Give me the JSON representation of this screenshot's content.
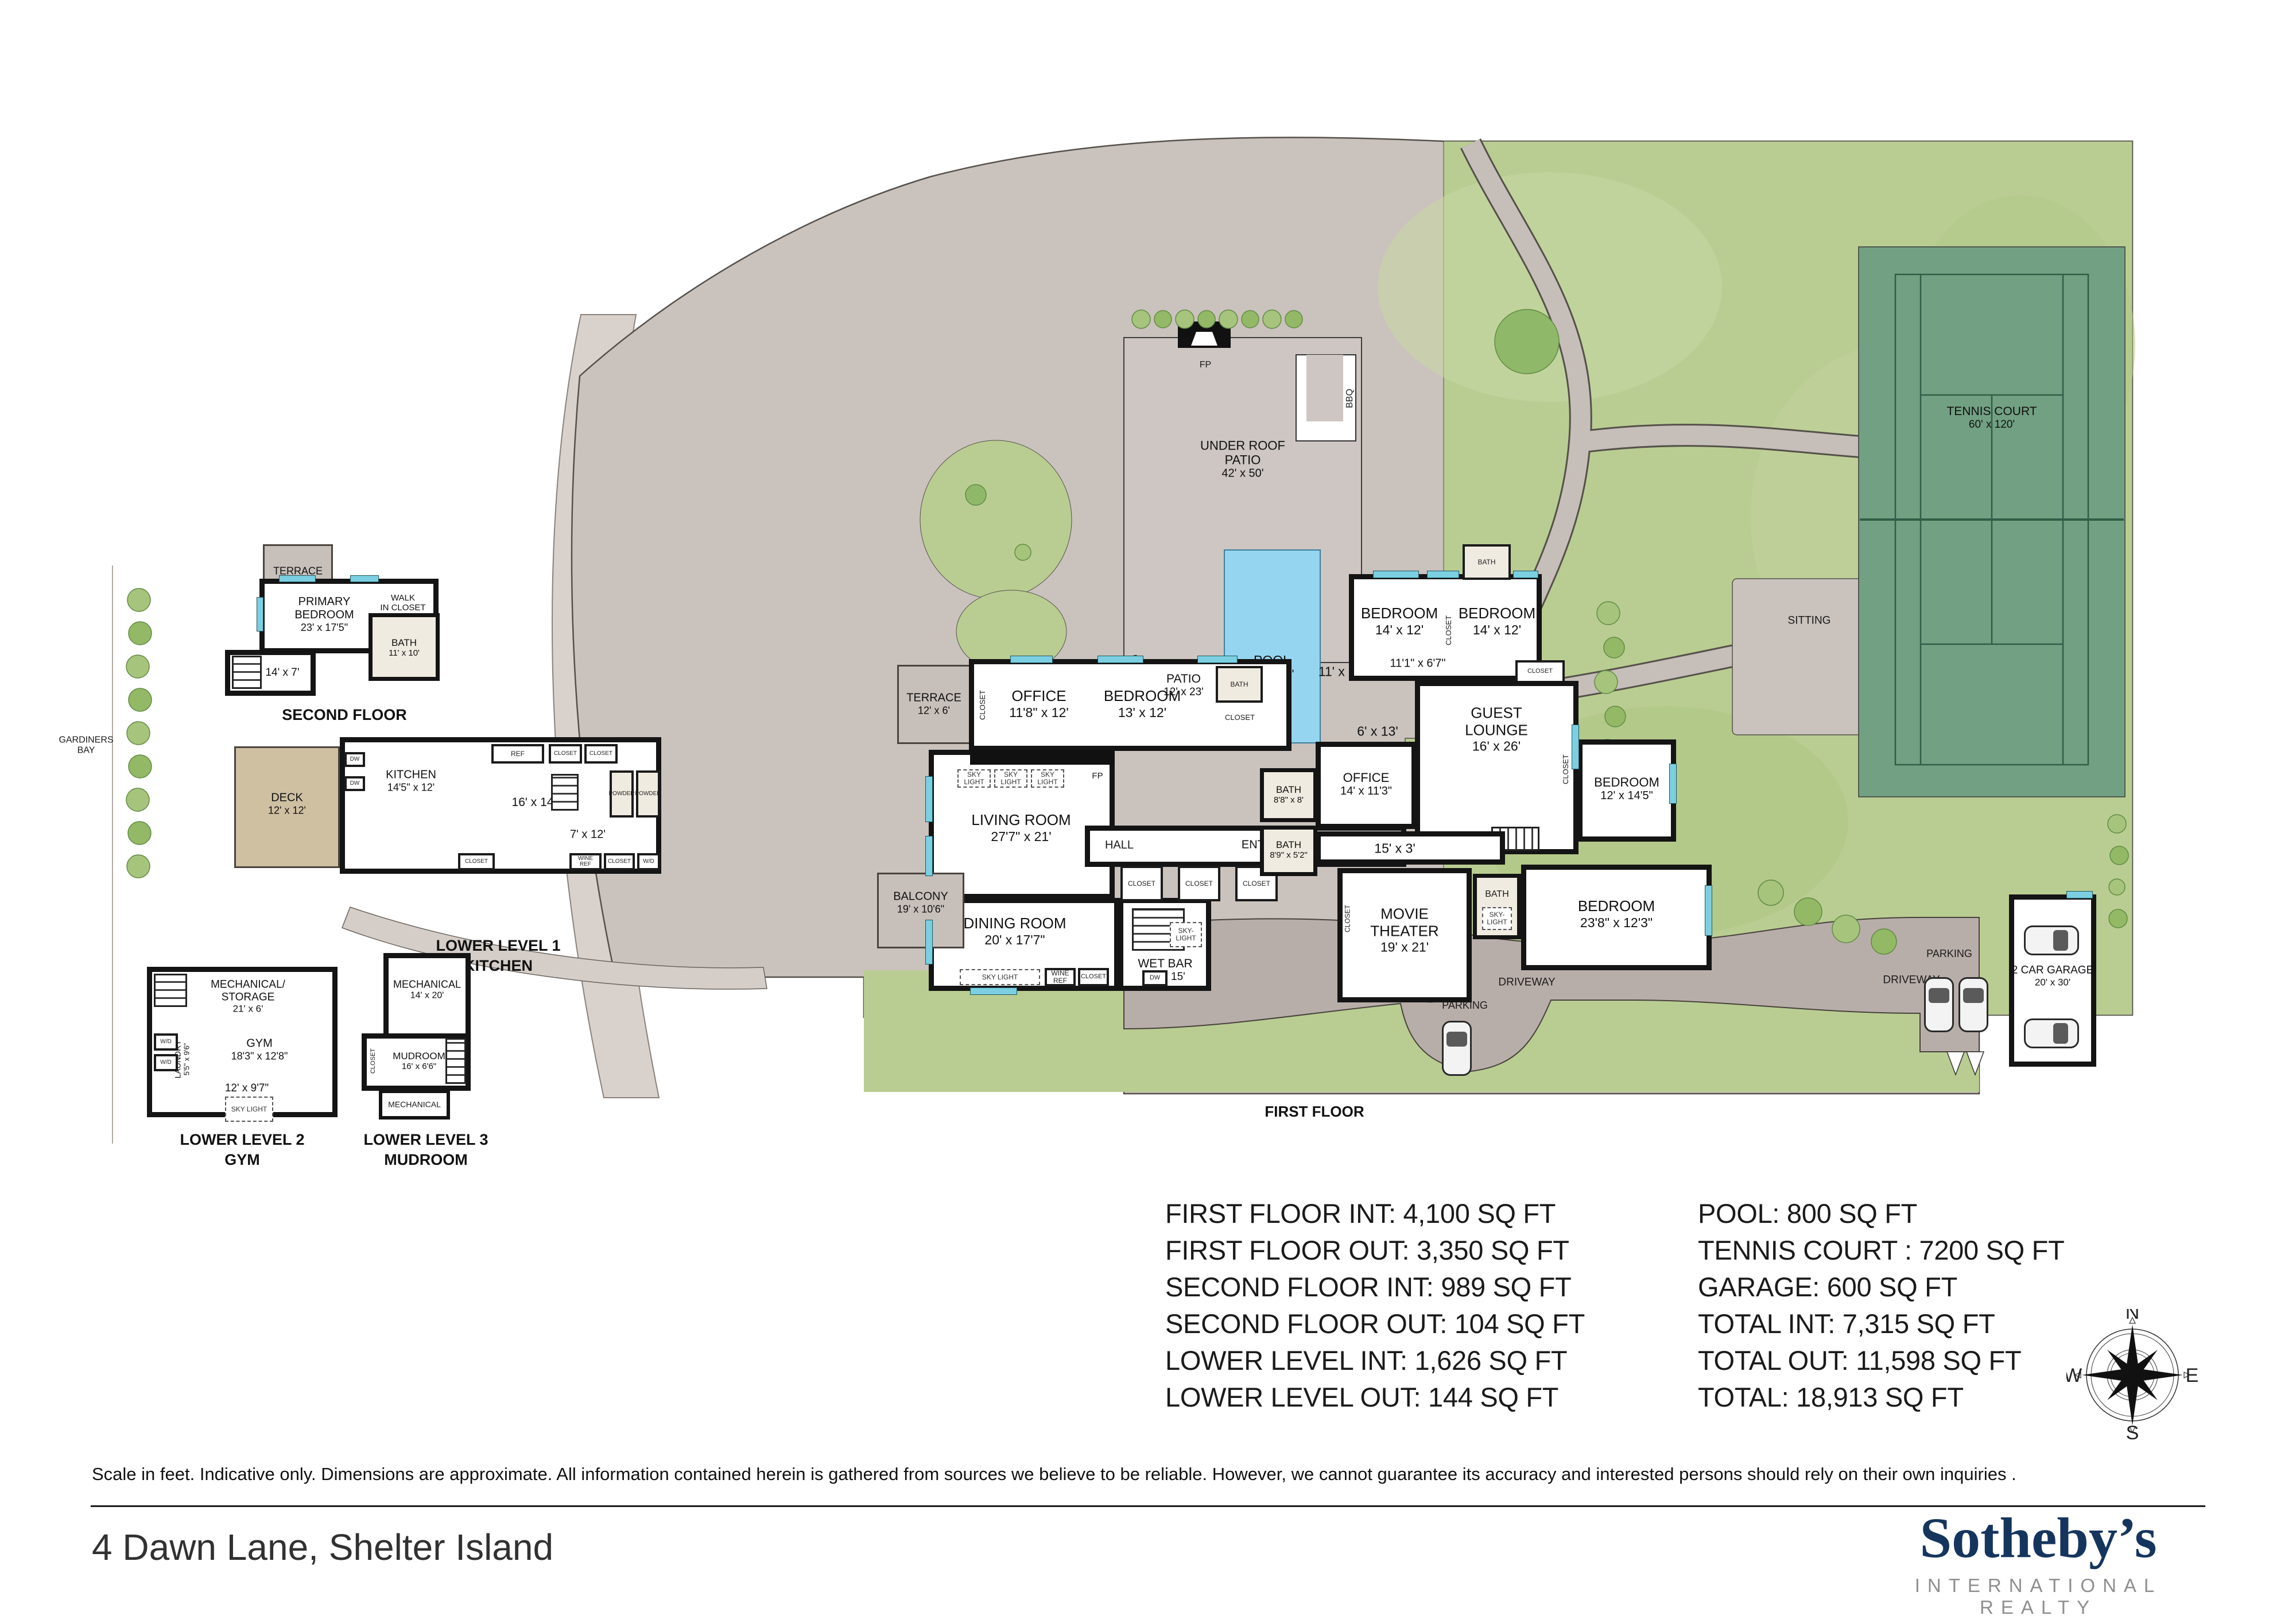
{
  "strings": {
    "closet": "CLOSET",
    "skylight": "SKY LIGHT",
    "skylight2": "SKY-\nLIGHT",
    "wine_ref": "WINE\nREF",
    "ref": "REF",
    "dw": "DW",
    "wd": "W/D",
    "bath": "BATH",
    "fp": "FP",
    "bbq": "BBQ",
    "hall": "HALL"
  },
  "site": {
    "sitting": "SITTING",
    "beach": "BEACH",
    "gardiners_bay": "GARDINERS\nBAY",
    "driveway": "DRIVEWAY",
    "parking": "PARKING",
    "first_floor_caption": "FIRST FLOOR",
    "tennis": {
      "name": "TENNIS COURT",
      "dims": "60' x 120'"
    },
    "under_roof": {
      "name": "UNDER ROOF\nPATIO",
      "dims": "42' x 50'"
    },
    "pool": {
      "name": "POOL",
      "dims": "20' x 40'"
    },
    "garage": {
      "name": "2 CAR GARAGE",
      "dims": "20' x 30'"
    }
  },
  "first_floor": {
    "living": {
      "name": "LIVING ROOM",
      "dims": "27'7\" x 21'"
    },
    "dining": {
      "name": "DINING ROOM",
      "dims": "20' x 17'7\""
    },
    "wetbar": {
      "name": "WET BAR",
      "dims": "13' x 15'"
    },
    "office_w": {
      "name": "OFFICE",
      "dims": "11'8\" x 12'"
    },
    "bedroom_w": {
      "name": "BEDROOM",
      "dims": "13' x 12'"
    },
    "bath_w": {
      "name": "BATH",
      "dims": "7' x 6'"
    },
    "terrace": {
      "name": "TERRACE",
      "dims": "12' x 6'"
    },
    "balcony": {
      "name": "BALCONY",
      "dims": "19' x 10'6\""
    },
    "bedroom_n1": {
      "name": "BEDROOM",
      "dims": "14' x 12'"
    },
    "bedroom_n2": {
      "name": "BEDROOM",
      "dims": "14' x 12'"
    },
    "bath_n": {
      "name": "BATH",
      "dims": "5' x 8'"
    },
    "lounge": {
      "name": "GUEST\nLOUNGE",
      "dims": "16' x 26'"
    },
    "office_e": {
      "name": "OFFICE",
      "dims": "14' x 11'3\""
    },
    "bath_e1": {
      "name": "BATH",
      "dims": "8'8\" x 8'"
    },
    "bath_e2": {
      "name": "BATH",
      "dims": "8'9\" x 5'2\""
    },
    "bedroom_e": {
      "name": "BEDROOM",
      "dims": "12' x 14'5\""
    },
    "movie": {
      "name": "MOVIE\nTHEATER",
      "dims": "19' x 21'"
    },
    "bedroom_s": {
      "name": "BEDROOM",
      "dims": "23'8\" x 12'3\""
    },
    "entry": {
      "name": "ENTRY",
      "dims": "39' x 6'9\""
    },
    "patio": {
      "name": "PATIO",
      "dims": "12' x 23'"
    },
    "d_pool_terrace": "11' x 35'",
    "d_6x13": "6' x 13'",
    "d_15x3": "15' x 3'",
    "d_hall_ne": "11'1\" x 6'7\""
  },
  "second_floor": {
    "caption": "SECOND FLOOR",
    "primary": {
      "name": "PRIMARY\nBEDROOM",
      "dims": "23' x 17'5\""
    },
    "walkin": {
      "name": "WALK\nIN CLOSET",
      "dims": "11' x 5'"
    },
    "bath": {
      "name": "BATH",
      "dims": "11' x 10'"
    },
    "terrace": {
      "name": "TERRACE",
      "dims": "11' x 9'5\""
    },
    "hall_dims": "14' x 7'"
  },
  "lower1": {
    "caption": "LOWER LEVEL 1\nKITCHEN",
    "deck": {
      "name": "DECK",
      "dims": "12' x 12'"
    },
    "kitchen": {
      "name": "KITCHEN",
      "dims": "14'5\" x 12'"
    },
    "d_16x14": "16' x 14'",
    "d_7x12": "7' x 12'",
    "powder": {
      "name": "POWDER",
      "dims": "4' x 6'"
    }
  },
  "lower2": {
    "caption": "LOWER LEVEL 2\nGYM",
    "mech": {
      "name": "MECHANICAL/\nSTORAGE",
      "dims": "21' x 6'"
    },
    "gym": {
      "name": "GYM",
      "dims": "18'3\" x 12'8\""
    },
    "laundry": {
      "name": "LAUNDRY",
      "dims": "5'5\" x 9'6\""
    },
    "d_12x97": "12' x 9'7\""
  },
  "lower3": {
    "caption": "LOWER LEVEL 3\nMUDROOM",
    "mech": {
      "name": "MECHANICAL",
      "dims": "14' x 20'"
    },
    "mud": {
      "name": "MUDROOM",
      "dims": "16' x 6'6\""
    },
    "mech2": "MECHANICAL"
  },
  "stats": {
    "left": [
      "FIRST FLOOR INT: 4,100 SQ FT",
      "FIRST FLOOR OUT: 3,350 SQ FT",
      "SECOND FLOOR INT: 989 SQ FT",
      "SECOND FLOOR OUT: 104 SQ FT",
      "LOWER LEVEL INT: 1,626 SQ FT",
      "LOWER LEVEL OUT: 144 SQ FT"
    ],
    "right": [
      "POOL: 800 SQ FT",
      "TENNIS COURT : 7200 SQ FT",
      "GARAGE: 600 SQ FT",
      "TOTAL INT: 7,315 SQ FT",
      "TOTAL OUT: 11,598 SQ FT",
      "TOTAL: 18,913 SQ FT"
    ]
  },
  "compass": {
    "n": "N",
    "e": "E",
    "s": "S",
    "w": "W"
  },
  "footer": {
    "disclaimer": "Scale in feet. Indicative only. Dimensions are approximate. All information contained herein is gathered from sources we believe to be reliable. However, we cannot guarantee its accuracy and interested persons should rely on their own  inquiries .",
    "address": "4 Dawn Lane, Shelter Island"
  },
  "logo": {
    "brand": "Sotheby’s",
    "sub": "INTERNATIONAL REALTY"
  }
}
